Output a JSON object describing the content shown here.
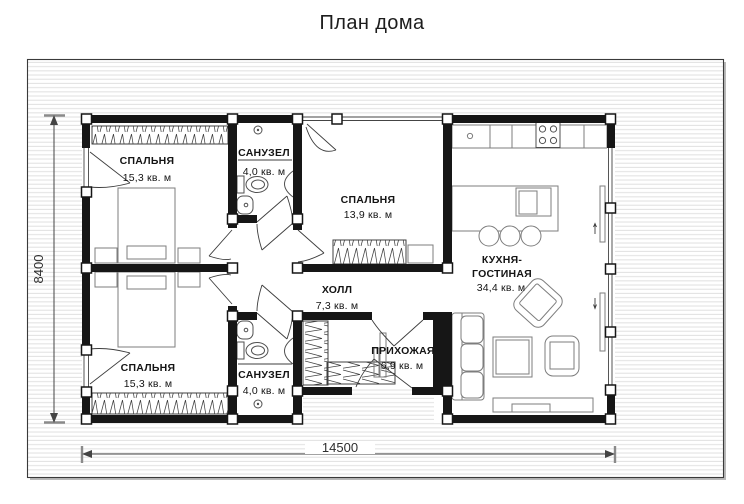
{
  "title": "План дома",
  "rooms": [
    {
      "id": "bedroom-top",
      "name": "СПАЛЬНЯ",
      "area": "15,3 кв. м"
    },
    {
      "id": "bathroom-top",
      "name": "САНУЗЕЛ",
      "area": "4,0 кв. м"
    },
    {
      "id": "bedroom-middle",
      "name": "СПАЛЬНЯ",
      "area": "13,9 кв. м"
    },
    {
      "id": "kitchen-living",
      "name_line1": "КУХНЯ-",
      "name_line2": "ГОСТИНАЯ",
      "area": "34,4 кв. м"
    },
    {
      "id": "hall",
      "name": "ХОЛЛ",
      "area": "7,3 кв. м"
    },
    {
      "id": "entry",
      "name": "ПРИХОЖАЯ",
      "area": "6,9 кв. м"
    },
    {
      "id": "bathroom-bottom",
      "name": "САНУЗЕЛ",
      "area": "4,0 кв. м"
    },
    {
      "id": "bedroom-bottom",
      "name": "СПАЛЬНЯ",
      "area": "15,3 кв. м"
    }
  ],
  "dimensions": {
    "overall_width_mm": "14500",
    "overall_height_mm": "8400"
  },
  "colors": {
    "wall": "#161616",
    "stripe": "#e2e2e2",
    "furniture_line": "#7d7d7d",
    "text": "#141414"
  }
}
